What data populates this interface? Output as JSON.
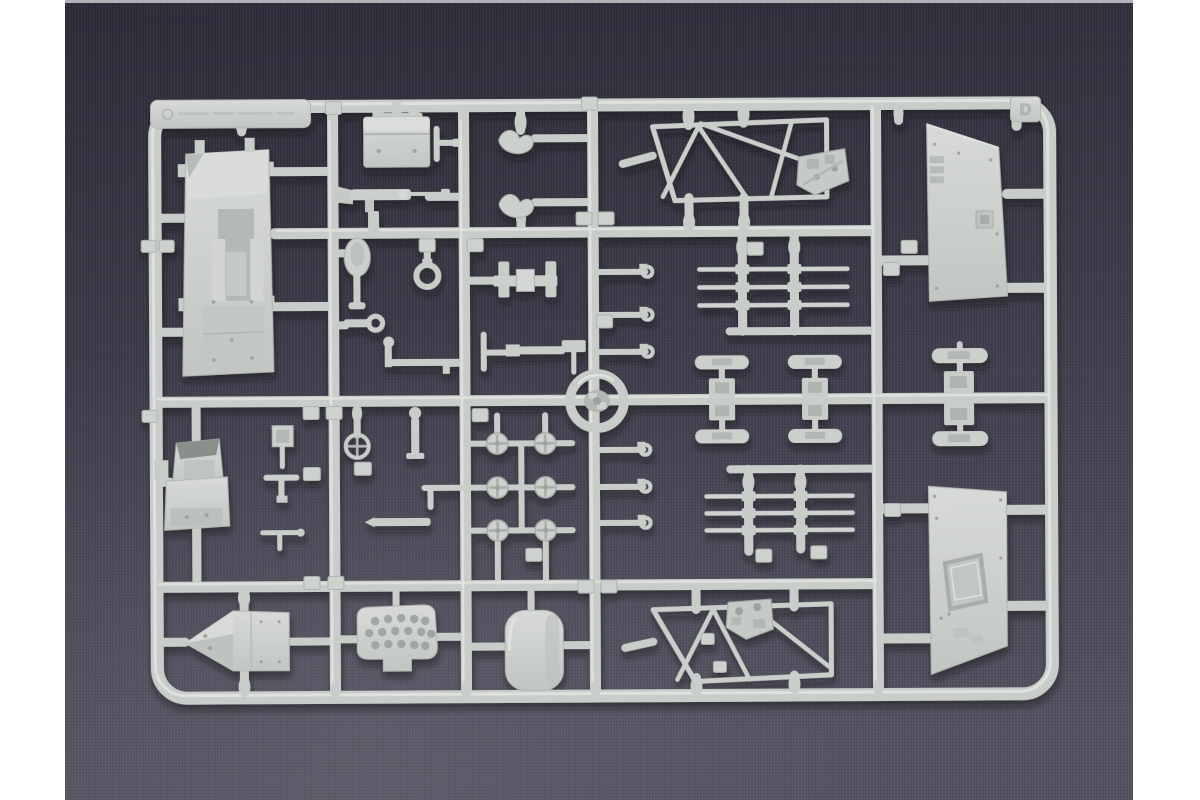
{
  "image": {
    "kind": "photograph",
    "subject": "Light grey injection-moulded model kit sprue (parts tree) photographed on a dark blue-grey cloth backdrop with white page margins left and right",
    "sprue_letter_tag": "D",
    "maker_tab": {
      "present": true,
      "embossed_text_legible": false
    },
    "part_number_tags": {
      "present": true,
      "embossed_digits_legible": false
    },
    "colors": {
      "page_margin": "#ffffff",
      "backdrop_top": "#2c2b38",
      "backdrop_bottom": "#535260",
      "plastic_base": "#c9cdc9",
      "plastic_highlight": "#e3e6e2",
      "plastic_shadow": "#9aa09c"
    },
    "parts": [
      {
        "name": "chassis-plate",
        "location": "upper-left"
      },
      {
        "name": "stowage-box",
        "location": "top-centre-left"
      },
      {
        "name": "machine-gun",
        "location": "centre-left"
      },
      {
        "name": "shovel",
        "location": "centre-left"
      },
      {
        "name": "ring-fitting",
        "location": "centre-left"
      },
      {
        "name": "tow-hooks",
        "location": "top-centre"
      },
      {
        "name": "gun-shield-frame-upper",
        "location": "top-centre-right"
      },
      {
        "name": "hull-side-panel-upper",
        "location": "top-right"
      },
      {
        "name": "torsion-bar-set-upper",
        "location": "centre-right"
      },
      {
        "name": "torsion-bar-set-lower",
        "location": "centre-right"
      },
      {
        "name": "hook-strips",
        "location": "centre"
      },
      {
        "name": "clamp-bracket",
        "location": "centre-left"
      },
      {
        "name": "hatch-ring",
        "location": "centre"
      },
      {
        "name": "track-link-sets",
        "location": "centre-right"
      },
      {
        "name": "road-wheel-cluster",
        "location": "lower-centre-left"
      },
      {
        "name": "driver-seat",
        "location": "centre-left"
      },
      {
        "name": "steering-wheel",
        "location": "centre-left"
      },
      {
        "name": "small-fittings",
        "location": "scattered"
      },
      {
        "name": "hull-nose",
        "location": "bottom-left"
      },
      {
        "name": "grille-panel",
        "location": "bottom-left-centre"
      },
      {
        "name": "fuel-tank",
        "location": "bottom-centre"
      },
      {
        "name": "gun-shield-frame-lower",
        "location": "bottom-centre-right"
      },
      {
        "name": "hull-side-panel-lower",
        "location": "bottom-right"
      }
    ]
  }
}
